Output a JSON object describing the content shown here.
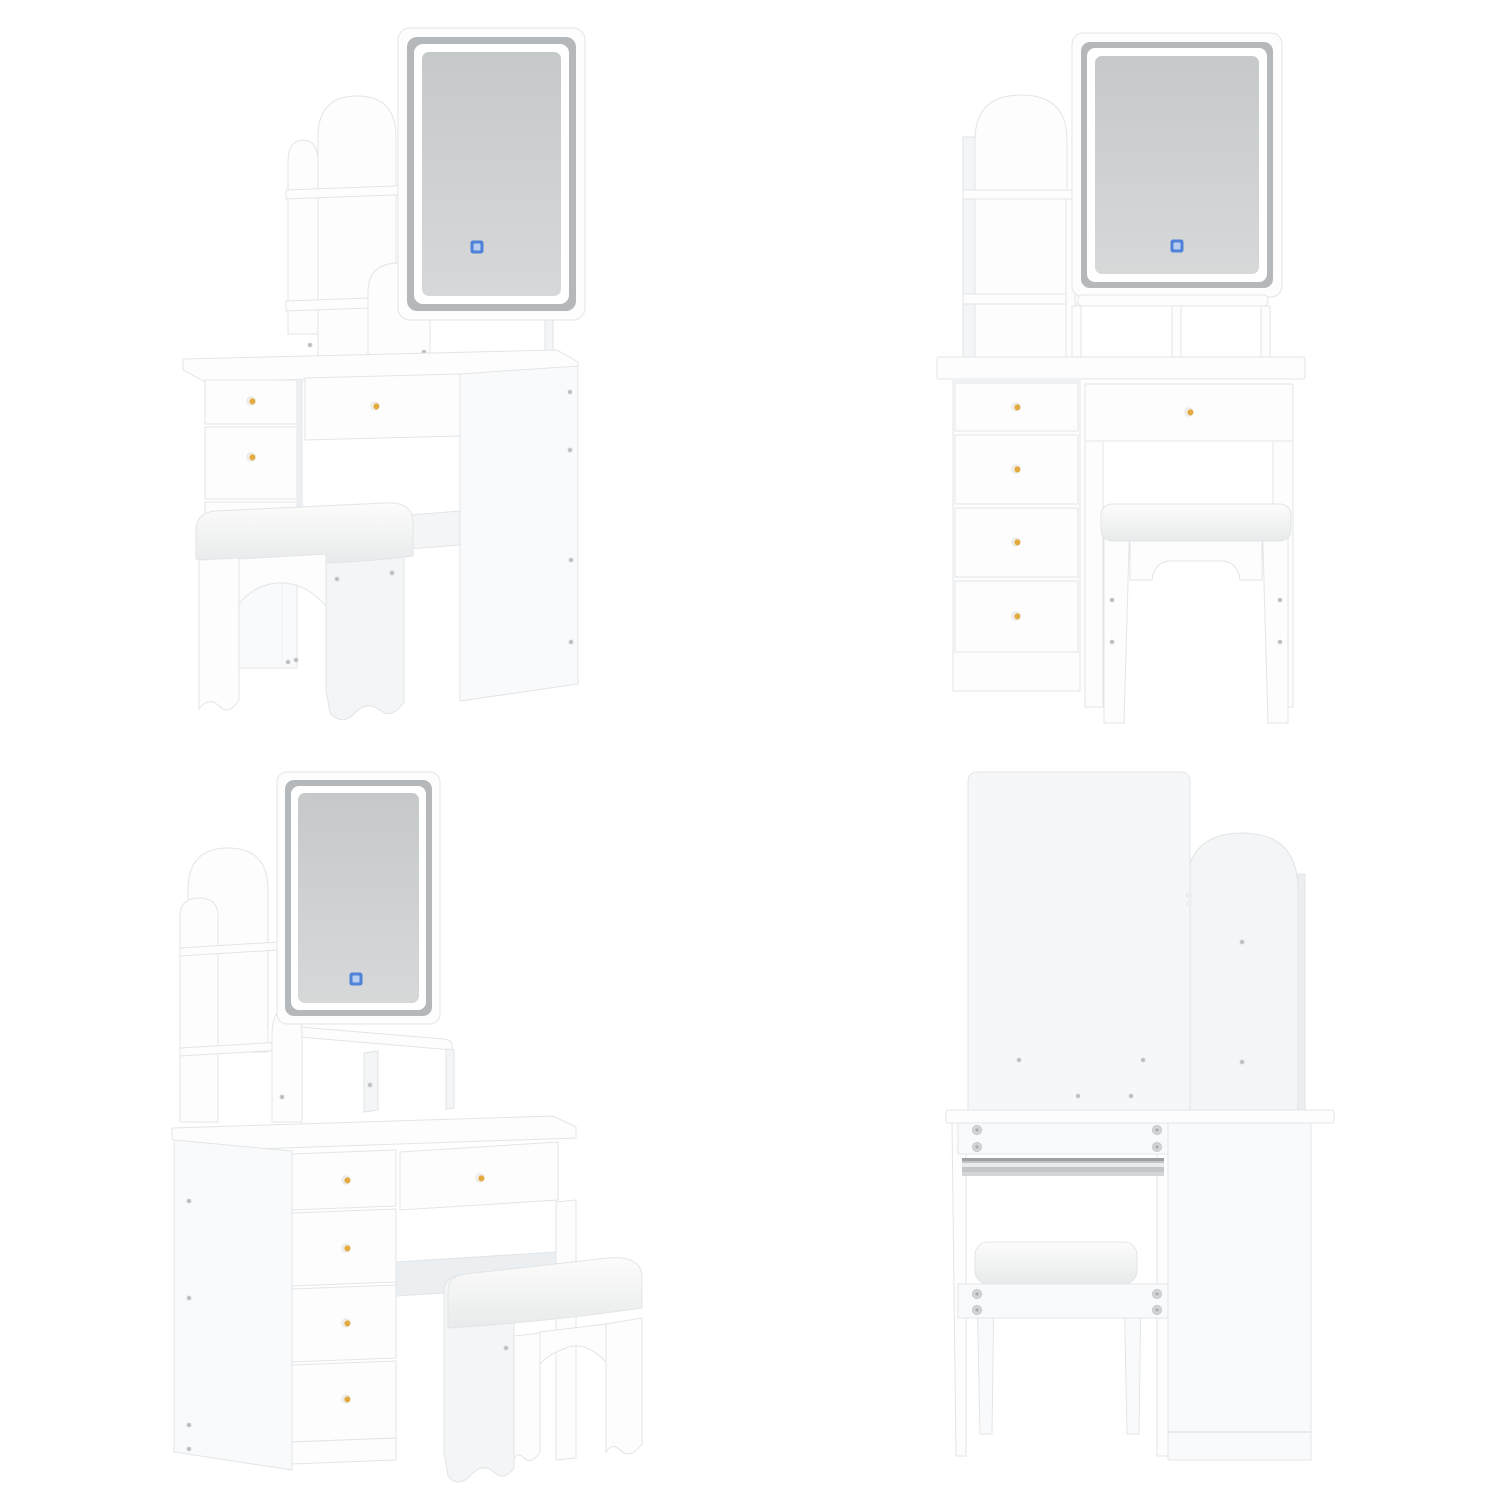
{
  "page": {
    "background": "#ffffff",
    "subject": "White vanity dressing table set with LED touch mirror, arched hutch shelves, five gold-knob drawers and cushioned stool, rendered from four angles on a white background"
  },
  "colors": {
    "surface_white": "#fdfdfd",
    "surface_shade": "#f3f5f6",
    "surface_deep": "#eceff1",
    "edge_gray": "#e2e5e7",
    "glass_margin_gray": "#b5b8ba",
    "glass_gray_dark": "#c6c9ca",
    "glass_gray_light": "#d6d8d9",
    "led_white": "#ffffff",
    "touch_icon_blue": "#4f82d8",
    "touch_icon_blue_light": "#b9cdf0",
    "knob_gold": "#e3aa3f",
    "knob_silver": "#f1f0ec",
    "screw_gray": "#c8cbcd",
    "cam_screw_gray": "#d2d5d7",
    "metal_rail_gray": "#c2c6c9",
    "cushion_top": "#fcfcfb",
    "cushion_bottom": "#e8eaeb"
  },
  "views": [
    {
      "id": "top-left",
      "name": "angled-view-from-right",
      "has_touch_icon": true,
      "visible_knobs": 3
    },
    {
      "id": "top-right",
      "name": "front-view",
      "has_touch_icon": true,
      "visible_knobs": 5
    },
    {
      "id": "bottom-left",
      "name": "angled-view-from-left",
      "has_touch_icon": true,
      "visible_knobs": 5
    },
    {
      "id": "bottom-right",
      "name": "back-view",
      "has_touch_icon": false,
      "visible_knobs": 0
    }
  ]
}
